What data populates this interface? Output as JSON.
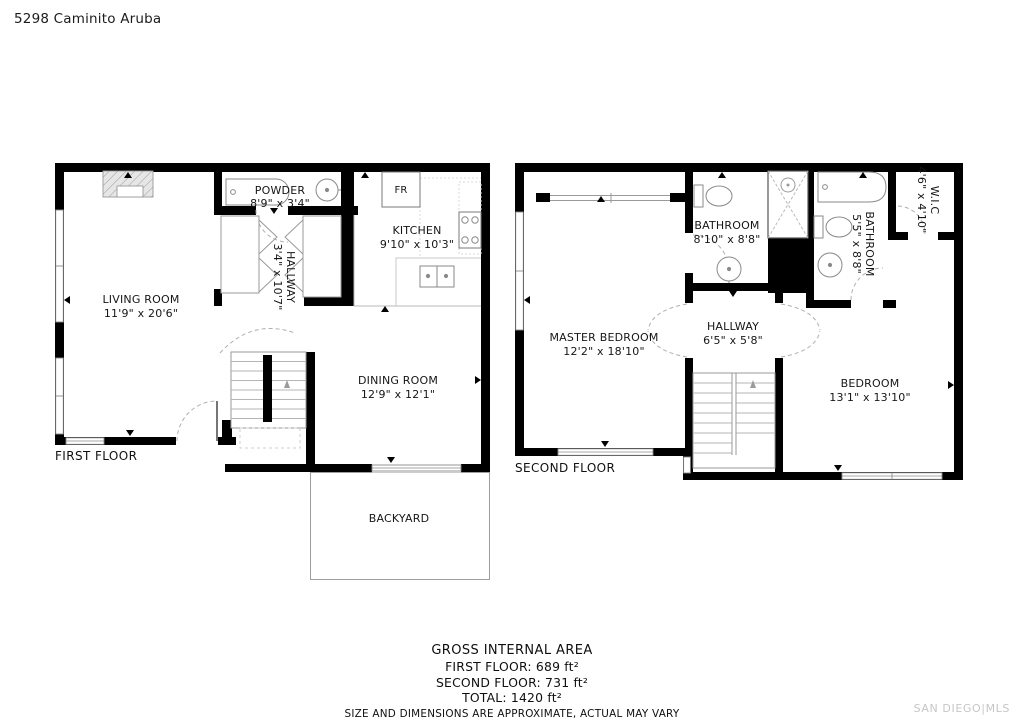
{
  "title": "5298 Caminito Aruba",
  "first_floor": {
    "floor_label": "FIRST FLOOR",
    "fridge_label": "FR",
    "rooms": {
      "living_room": {
        "name": "LIVING ROOM",
        "dims": "11'9\" x 20'6\""
      },
      "powder": {
        "name": "POWDER",
        "dims": "8'9\" x 3'4\""
      },
      "kitchen": {
        "name": "KITCHEN",
        "dims": "9'10\" x 10'3\""
      },
      "hallway": {
        "name": "HALLWAY",
        "dims": "3'4\" x 10'7\""
      },
      "dining_room": {
        "name": "DINING ROOM",
        "dims": "12'9\" x 12'1\""
      },
      "backyard": {
        "name": "BACKYARD"
      }
    }
  },
  "second_floor": {
    "floor_label": "SECOND FLOOR",
    "rooms": {
      "master_bedroom": {
        "name": "MASTER BEDROOM",
        "dims": "12'2\" x 18'10\""
      },
      "bathroom1": {
        "name": "BATHROOM",
        "dims": "8'10\" x 8'8\""
      },
      "bathroom2": {
        "name": "BATHROOM",
        "dims": "5'5\" x 8'8\""
      },
      "wic": {
        "name": "W.I.C",
        "dims": "4'6\" x 4'10\""
      },
      "hallway": {
        "name": "HALLWAY",
        "dims": "6'5\" x 5'8\""
      },
      "bedroom": {
        "name": "BEDROOM",
        "dims": "13'1\" x 13'10\""
      }
    }
  },
  "summary": {
    "heading": "GROSS INTERNAL AREA",
    "first_floor": "FIRST FLOOR: 689 ft²",
    "second_floor": "SECOND FLOOR: 731 ft²",
    "total": "TOTAL: 1420 ft²",
    "disclaimer": "SIZE AND DIMENSIONS ARE APPROXIMATE, ACTUAL MAY VARY"
  },
  "watermark": "SAN DIEGO|MLS",
  "colors": {
    "wall": "#000000",
    "fixture": "#8a8a8a",
    "watermark": "#c6c6c6"
  }
}
